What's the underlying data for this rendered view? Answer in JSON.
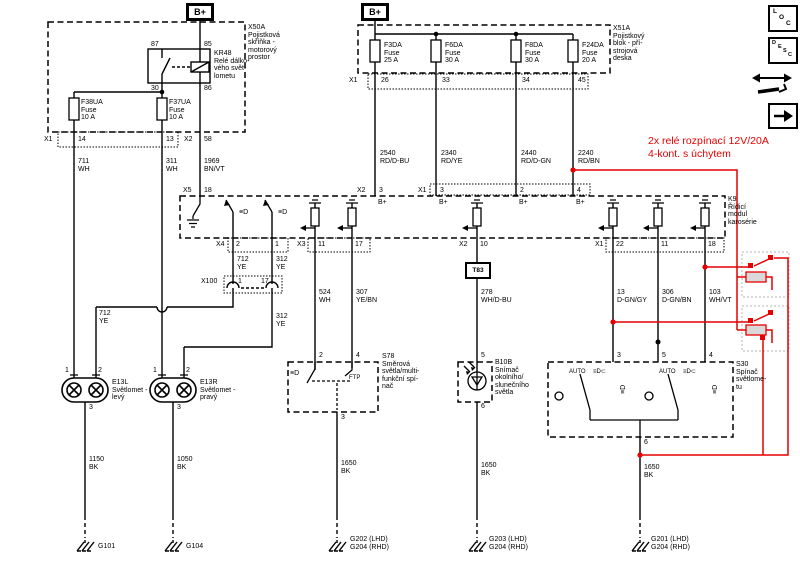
{
  "power": {
    "left": "B+",
    "mid": "B+"
  },
  "toolbar": {
    "loc": [
      "L",
      "O",
      "C"
    ],
    "desc": [
      "D",
      "E",
      "S",
      "C"
    ]
  },
  "annotation": "2x relé rozpínací 12V/20A\n4-kont. s úchytem",
  "icons": {
    "lamp": "≡D",
    "switch_positions": "≡D⊂"
  },
  "x50a": {
    "label": "X50A\nPojistková\nskříňka -\nmotorový\nprostor",
    "kr48": "KR48\nRelé dálko-\nvého svět-\nlometu",
    "pin87": "87",
    "pin85": "85",
    "pin30": "30",
    "pin86": "86",
    "fuse1": "F38UA\nFuse\n10 A",
    "fuse2": "F37UA\nFuse\n10 A",
    "x1": "X1",
    "pin14": "14",
    "pin13": "13",
    "x2": "X2",
    "pin58": "58"
  },
  "x51a": {
    "label": "X51A\nPojistkový\nblok - pří-\nstrojová\ndeska",
    "fuses": [
      "F3DA\nFuse\n25 A",
      "F6DA\nFuse\n30 A",
      "F8DA\nFuse\n30 A",
      "F24DA\nFuse\n20 A"
    ],
    "x1": "X1",
    "pins": [
      "26",
      "33",
      "34",
      "45"
    ]
  },
  "wires": {
    "w711": "711\nWH",
    "w311": "311\nWH",
    "w1969": "1969\nBN/VT",
    "w2540": "2540\nRD/D-BU",
    "w2340": "2340\nRD/YE",
    "w2440": "2440\nRD/D-GN",
    "w2240": "2240\nRD/BN",
    "w712a": "712\nYE",
    "w312a": "312\nYE",
    "w712b": "712\nYE",
    "w312b": "312\nYE",
    "w524": "524\nWH",
    "w307": "307\nYE/BN",
    "w278": "278\nWH/D-BU",
    "w13": "13\nD-GN/GY",
    "w306": "306\nD-GN/BN",
    "w103": "103\nWH/VT",
    "w1150": "1150\nBK",
    "w1050": "1050\nBK",
    "w1650a": "1650\nBK",
    "w1650b": "1650\nBK",
    "w1650c": "1650\nBK"
  },
  "bcm": {
    "label": "K9\nŘídicí\nmodul\nkarosérie",
    "x5": "X5",
    "p18": "18",
    "x2": "X2",
    "p3a": "3",
    "x1": "X1",
    "p3b": "3",
    "p2": "2",
    "p4": "4",
    "bplus": [
      "B+",
      "B+",
      "B+",
      "B+"
    ],
    "x4": "X4",
    "p2b": "2",
    "p1b": "1",
    "x3": "X3",
    "p11": "11",
    "p17": "17",
    "x2b": "X2",
    "p10": "10",
    "x1b": "X1",
    "p22": "22",
    "p11b": "11",
    "p18b": "18"
  },
  "x100": {
    "label": "X100",
    "p1": "1",
    "p17": "17"
  },
  "t83": "T83",
  "e13l": {
    "label": "E13L\nSvětlomet -\nlevý",
    "p1": "1",
    "p2": "2",
    "p3": "3"
  },
  "e13r": {
    "label": "E13R\nSvětlomet -\npravý",
    "p1": "1",
    "p2": "2",
    "p3": "3"
  },
  "s78": {
    "label": "S78\nSměrová\nsvětla/multi-\nfunkční spí-\nnač",
    "p2": "2",
    "p4": "4",
    "p3": "3",
    "ftp": "FTP"
  },
  "b10b": {
    "label": "B10B\nSnímač\nokolního/\nslunečního\nsvětla",
    "p5": "5",
    "p6": "6"
  },
  "s30": {
    "label": "S30\nSpínač\nsvětlome-\ntu",
    "p3": "3",
    "p5": "5",
    "p4": "4",
    "p6": "6",
    "auto1": "AUTO",
    "auto2": "AUTO"
  },
  "grounds": {
    "g101": "G101",
    "g104": "G104",
    "g202": "G202 (LHD)\nG204 (RHD)",
    "g203": "G203 (LHD)\nG204 (RHD)",
    "g201": "G201 (LHD)\nG204 (RHD)"
  },
  "colors": {
    "wire": "#000000",
    "mod_red": "#e60000"
  }
}
